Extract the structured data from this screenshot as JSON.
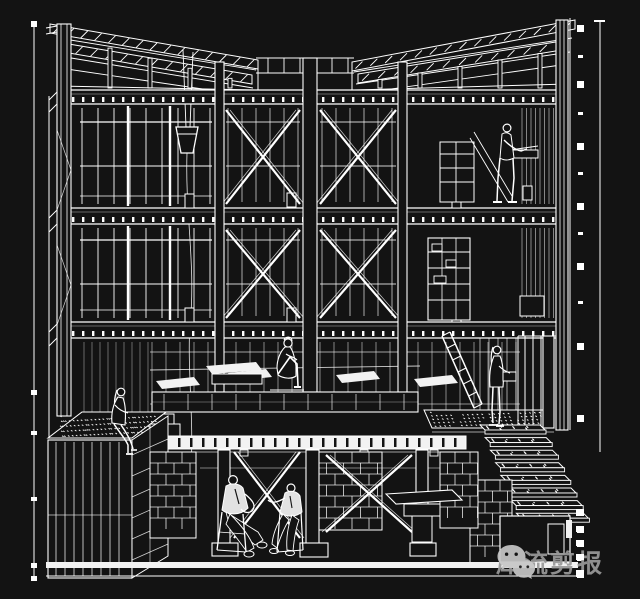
{
  "colors": {
    "background": "#131313",
    "line": "#ffffff",
    "bright_fill": "#f2f2f2",
    "suit_fill": "#e2e2e2",
    "watermark_icon": "#c6c6c6",
    "watermark_text": "#9a9a9a"
  },
  "drawing": {
    "type": "architectural-section-perspective",
    "subject": "three-storey timber frame house cutaway with butterfly roof, cross-braced bays, raised platform, basement, roof planter and exterior stair",
    "figures": [
      "person-standing-upper-floor",
      "person-sitting-on-platform",
      "person-sitting-on-planter",
      "person-standing-on-terrace",
      "person-on-chair-left",
      "person-on-chair-right"
    ]
  },
  "watermark": {
    "icon": "wechat-icon",
    "text": "犀流剪报"
  }
}
